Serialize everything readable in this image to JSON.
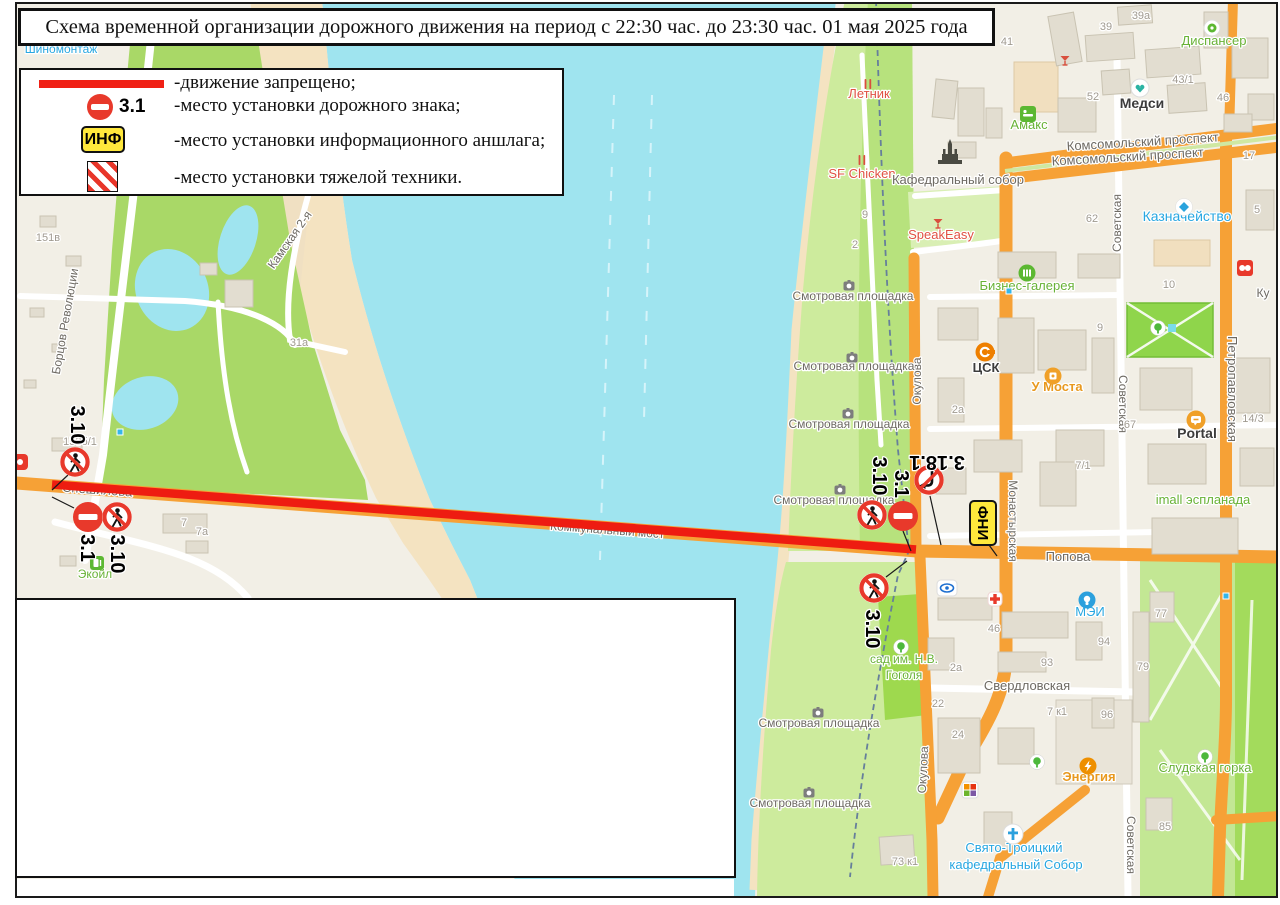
{
  "title": {
    "text": "Схема временной организации дорожного движения на период с 22:30 час. до 23:30 час. 01 мая 2025 года"
  },
  "legend": {
    "items": [
      {
        "symbol": "red-line",
        "label": "-движение запрещено;"
      },
      {
        "symbol": "sign-3.1",
        "sign_number": "3.1",
        "label": "-место установки дорожного знака;"
      },
      {
        "symbol": "info-board",
        "symbol_text": "ИНФ",
        "label": "-место установки информационного аншлага;"
      },
      {
        "symbol": "heavy-equipment",
        "label": "-место установки тяжелой техники."
      }
    ]
  },
  "map": {
    "colors": {
      "water": "#9fe4ef",
      "land": "#f2efe6",
      "beach": "#f4e3c1",
      "park": "#a9d867",
      "light_green": "#cdeb9d",
      "bright_green": "#9ed94e",
      "road_orange": "#f6a136",
      "red_line": "#ee1c11",
      "sign_red": "#e8392b",
      "info_yellow": "#ffe83c",
      "street": "#6e6a63",
      "num": "#a09a90",
      "green": "#68b236",
      "blue": "#28a7e1",
      "red": "#e05243",
      "orange": "#e8991f",
      "dark": "#3c3c3c"
    },
    "street_labels": [
      {
        "t": "Спешилова",
        "x": 97,
        "y": 494,
        "r": 4,
        "s": 13,
        "u": 1
      },
      {
        "t": "Коммунальный мост",
        "x": 607,
        "y": 534,
        "r": 4.3,
        "s": 12,
        "u": 1
      },
      {
        "t": "Борцов Революции",
        "x": 69,
        "y": 322,
        "r": -80,
        "s": 12
      },
      {
        "t": "Камская 2-я",
        "x": 293,
        "y": 242,
        "r": -55,
        "s": 12
      },
      {
        "t": "Окулова",
        "x": 921,
        "y": 381,
        "r": -90,
        "s": 12
      },
      {
        "t": "Окулова",
        "x": 927,
        "y": 770,
        "r": -87,
        "s": 12
      },
      {
        "t": "Монастырская",
        "x": 1009,
        "y": 521,
        "r": 90,
        "s": 12
      },
      {
        "t": "Попова",
        "x": 1068,
        "y": 561,
        "r": 0,
        "s": 13
      },
      {
        "t": "Комсомольский проспект",
        "x": 1143,
        "y": 146,
        "r": -3.5,
        "s": 13
      },
      {
        "t": "Комсомольский проспект",
        "x": 1128,
        "y": 161,
        "r": -3.5,
        "s": 13
      },
      {
        "t": "Советская",
        "x": 1121,
        "y": 223,
        "r": -90,
        "s": 12
      },
      {
        "t": "Советская",
        "x": 1119,
        "y": 404,
        "r": 90,
        "s": 12
      },
      {
        "t": "Советская",
        "x": 1127,
        "y": 845,
        "r": 90,
        "s": 12
      },
      {
        "t": "Петропавловская",
        "x": 1228,
        "y": 389,
        "r": 90,
        "s": 13
      },
      {
        "t": "Свердловская",
        "x": 1027,
        "y": 690,
        "r": 0,
        "s": 13
      },
      {
        "t": "Ку",
        "x": 1263,
        "y": 297,
        "r": 0,
        "s": 12
      }
    ],
    "poi_labels": [
      {
        "t": "Шиномонтаж",
        "x": 61,
        "y": 53,
        "c": "blue",
        "s": 12
      },
      {
        "t": "Летник",
        "x": 869,
        "y": 98,
        "c": "red",
        "s": 13
      },
      {
        "t": "SF Chicken",
        "x": 862,
        "y": 178,
        "c": "red",
        "s": 13
      },
      {
        "t": "Кафедральный собор",
        "x": 958,
        "y": 184,
        "c": "street",
        "s": 13
      },
      {
        "t": "Амакс",
        "x": 1029,
        "y": 129,
        "c": "green",
        "s": 13
      },
      {
        "t": "SpeakEasy",
        "x": 941,
        "y": 239,
        "c": "red",
        "s": 13
      },
      {
        "t": "Бизнес-галерея",
        "x": 1027,
        "y": 290,
        "c": "green",
        "s": 13
      },
      {
        "t": "ЦСК",
        "x": 986,
        "y": 372,
        "c": "dark",
        "s": 13,
        "b": 1
      },
      {
        "t": "У Моста",
        "x": 1057,
        "y": 391,
        "c": "orange",
        "s": 13,
        "b": 1
      },
      {
        "t": "Portal",
        "x": 1197,
        "y": 438,
        "c": "dark",
        "s": 14,
        "b": 1
      },
      {
        "t": "imall эспланада",
        "x": 1203,
        "y": 504,
        "c": "green",
        "s": 13
      },
      {
        "t": "Казначейство",
        "x": 1187,
        "y": 221,
        "c": "blue",
        "s": 14
      },
      {
        "t": "Медси",
        "x": 1142,
        "y": 108,
        "c": "dark",
        "s": 14,
        "b": 1
      },
      {
        "t": "Диспансер",
        "x": 1214,
        "y": 45,
        "c": "green",
        "s": 13
      },
      {
        "t": "МЭИ",
        "x": 1090,
        "y": 616,
        "c": "blue",
        "s": 13
      },
      {
        "t": "Энергия",
        "x": 1089,
        "y": 781,
        "c": "orange",
        "s": 13,
        "b": 1
      },
      {
        "t": "Слудская горка",
        "x": 1205,
        "y": 772,
        "c": "green",
        "s": 13
      },
      {
        "t": "Свято-Троицкий",
        "x": 1014,
        "y": 852,
        "c": "blue",
        "s": 13
      },
      {
        "t": "кафедральный Собор",
        "x": 1016,
        "y": 869,
        "c": "blue",
        "s": 13
      },
      {
        "t": "сад им. Н.В.",
        "x": 904,
        "y": 663,
        "c": "green",
        "s": 12
      },
      {
        "t": "Гоголя",
        "x": 904,
        "y": 679,
        "c": "green",
        "s": 12
      },
      {
        "t": "Экойл",
        "x": 95,
        "y": 578,
        "c": "green",
        "s": 12
      },
      {
        "t": "Смотровая площадка",
        "x": 853,
        "y": 300,
        "c": "street",
        "s": 12
      },
      {
        "t": "Смотровая площадка",
        "x": 854,
        "y": 370,
        "c": "street",
        "s": 12
      },
      {
        "t": "Смотровая площадка",
        "x": 849,
        "y": 428,
        "c": "street",
        "s": 12
      },
      {
        "t": "Смотровая площадка",
        "x": 834,
        "y": 504,
        "c": "street",
        "s": 12
      },
      {
        "t": "Смотровая площадка",
        "x": 819,
        "y": 727,
        "c": "street",
        "s": 12
      },
      {
        "t": "Смотровая площадка",
        "x": 810,
        "y": 807,
        "c": "street",
        "s": 12
      }
    ],
    "numbers": [
      {
        "t": "151в",
        "x": 48,
        "y": 241
      },
      {
        "t": "31а",
        "x": 299,
        "y": 346
      },
      {
        "t": "153б/1",
        "x": 80,
        "y": 445
      },
      {
        "t": "7а",
        "x": 202,
        "y": 535
      },
      {
        "t": "7",
        "x": 184,
        "y": 526
      },
      {
        "t": "9",
        "x": 865,
        "y": 218
      },
      {
        "t": "2",
        "x": 855,
        "y": 248
      },
      {
        "t": "41",
        "x": 1007,
        "y": 45
      },
      {
        "t": "39",
        "x": 1106,
        "y": 30
      },
      {
        "t": "39а",
        "x": 1141,
        "y": 19
      },
      {
        "t": "43/1",
        "x": 1183,
        "y": 83
      },
      {
        "t": "52",
        "x": 1093,
        "y": 100
      },
      {
        "t": "46",
        "x": 1223,
        "y": 101
      },
      {
        "t": "62",
        "x": 1092,
        "y": 222
      },
      {
        "t": "17",
        "x": 1249,
        "y": 159
      },
      {
        "t": "9",
        "x": 1100,
        "y": 331
      },
      {
        "t": "10",
        "x": 1169,
        "y": 288
      },
      {
        "t": "2а",
        "x": 958,
        "y": 413
      },
      {
        "t": "67",
        "x": 1130,
        "y": 428
      },
      {
        "t": "14/3",
        "x": 1253,
        "y": 422
      },
      {
        "t": "7/1",
        "x": 1083,
        "y": 469
      },
      {
        "t": "46",
        "x": 994,
        "y": 632
      },
      {
        "t": "77",
        "x": 1161,
        "y": 617
      },
      {
        "t": "94",
        "x": 1104,
        "y": 645
      },
      {
        "t": "93",
        "x": 1047,
        "y": 666
      },
      {
        "t": "2а",
        "x": 956,
        "y": 671
      },
      {
        "t": "22",
        "x": 938,
        "y": 707
      },
      {
        "t": "24",
        "x": 958,
        "y": 738
      },
      {
        "t": "7 к1",
        "x": 1057,
        "y": 715
      },
      {
        "t": "96",
        "x": 1107,
        "y": 718
      },
      {
        "t": "79",
        "x": 1143,
        "y": 670
      },
      {
        "t": "85",
        "x": 1165,
        "y": 830
      },
      {
        "t": "73 к1",
        "x": 905,
        "y": 865
      },
      {
        "t": "5",
        "x": 1257,
        "y": 213
      }
    ],
    "signs": [
      {
        "type": "3.10",
        "x": 75,
        "y": 462,
        "rot": 0,
        "label": "3.10",
        "lx": 71,
        "ly": 425,
        "lrot": 90
      },
      {
        "type": "3.1",
        "x": 88,
        "y": 517,
        "rot": 0,
        "label": "3.1",
        "lx": 81,
        "ly": 548,
        "lrot": 90
      },
      {
        "type": "3.10",
        "x": 117,
        "y": 517,
        "rot": 0,
        "label": "3.10",
        "lx": 111,
        "ly": 554,
        "lrot": 90
      },
      {
        "type": "3.10",
        "x": 872,
        "y": 515,
        "rot": 0,
        "label": "3.10",
        "lx": 873,
        "ly": 476,
        "lrot": 90
      },
      {
        "type": "3.1",
        "x": 903,
        "y": 516,
        "rot": 0,
        "label": "3.1",
        "lx": 895,
        "ly": 484,
        "lrot": 90
      },
      {
        "type": "3.18.1",
        "x": 929,
        "y": 480,
        "rot": 180,
        "label": "3.18.1",
        "lx": 937,
        "ly": 456,
        "lrot": 180
      },
      {
        "type": "3.10",
        "x": 874,
        "y": 588,
        "rot": 0,
        "label": "3.10",
        "lx": 866,
        "ly": 629,
        "lrot": 90
      }
    ],
    "inf": {
      "text": "ИНФ",
      "x": 983,
      "y": 523
    }
  }
}
